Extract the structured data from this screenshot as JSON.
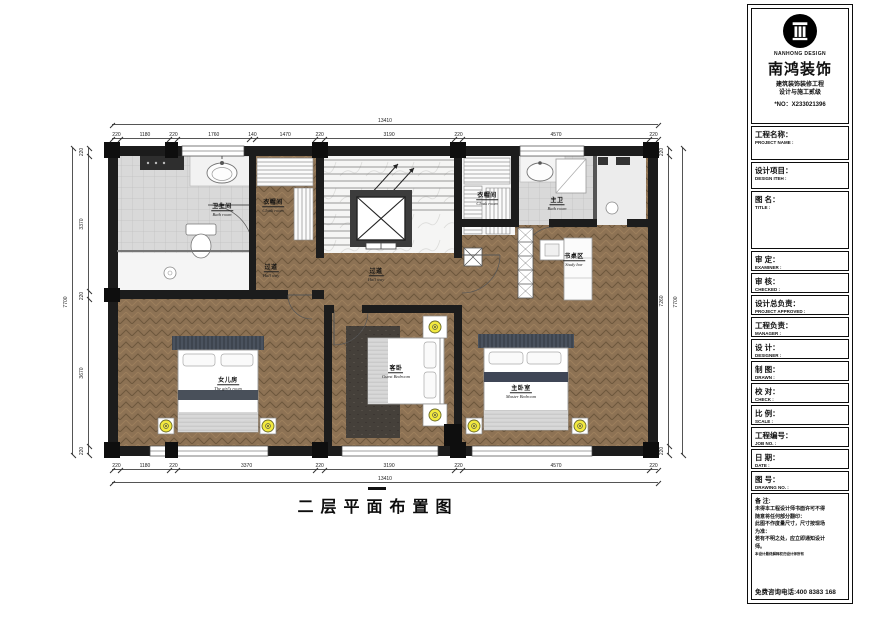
{
  "sheet": {
    "drawing_title": "二层平面布置图",
    "company": {
      "logo": "roman-column-logo",
      "name_en": "NANHONG DESIGN",
      "name_cn": "南鸿装饰",
      "cert_line1": "建筑装饰装修工程",
      "cert_line2": "设计与施工贰级",
      "license_no": "*NO：X233021396"
    },
    "fields": [
      {
        "cn": "工程名称：",
        "en": "PROJECT NAME :"
      },
      {
        "cn": "设计项目：",
        "en": "DESIGN ITEH :"
      },
      {
        "cn": "图  名：",
        "en": "TITLE :"
      },
      {
        "cn": "审  定：",
        "en": "EXAMINER :"
      },
      {
        "cn": "审  核：",
        "en": "CHECKED :"
      },
      {
        "cn": "设计总负责：",
        "en": "PROJECT APPROVED :"
      },
      {
        "cn": "工程负责：",
        "en": "MANAGER :"
      },
      {
        "cn": "设  计：",
        "en": "DESIGNER :"
      },
      {
        "cn": "制  图：",
        "en": "DRAWN :"
      },
      {
        "cn": "校  对：",
        "en": "CHECK :"
      },
      {
        "cn": "比  例：",
        "en": "SCALE :"
      },
      {
        "cn": "工程编号：",
        "en": "JOB  NO. :"
      },
      {
        "cn": "日  期：",
        "en": "DATE :"
      },
      {
        "cn": "图  号：",
        "en": "DRAWING NO. :"
      }
    ],
    "notes": {
      "label": "备 注:",
      "lines": [
        "未得本工程设计师书面许可不得",
        "随意将任何部分翻印：",
        "此图不作度量尺寸，尺寸按现场",
        "为准：",
        "若有不明之处，应立即通知设计",
        "师。"
      ],
      "fine_print": "本设计最终解释权归设计师所有",
      "hotline": "免费咨询电话:400 8383 168"
    }
  },
  "dimensions": {
    "top": {
      "overall": "13410",
      "segments": [
        "220",
        "1180",
        "220",
        "1760",
        "140",
        "1470",
        "220",
        "3190",
        "220",
        "4570",
        "220"
      ]
    },
    "bottom": {
      "overall": "13410",
      "segments": [
        "220",
        "1180",
        "220",
        "3370",
        "220",
        "3190",
        "220",
        "4570",
        "220"
      ]
    },
    "left": {
      "overall": "7700",
      "segments": [
        "220",
        "3370",
        "220",
        "3670",
        "220"
      ]
    },
    "right": {
      "overall": "7700",
      "segments": [
        "220",
        "7260",
        "220"
      ]
    }
  },
  "rooms": [
    {
      "cn": "卫生间",
      "en": "Bath room",
      "x": 222,
      "y": 207
    },
    {
      "cn": "衣帽间",
      "en": "Cloak room",
      "x": 273,
      "y": 203
    },
    {
      "cn": "过道",
      "en": "Hall way",
      "x": 271,
      "y": 268
    },
    {
      "cn": "女儿房",
      "en": "The girl's room",
      "x": 228,
      "y": 381
    },
    {
      "cn": "过道",
      "en": "Hall way",
      "x": 376,
      "y": 272
    },
    {
      "cn": "客卧",
      "en": "Guest Bedroom",
      "x": 396,
      "y": 369
    },
    {
      "cn": "主卧室",
      "en": "Master Bedroom",
      "x": 521,
      "y": 389
    },
    {
      "cn": "书桌区",
      "en": "Study bar",
      "x": 574,
      "y": 257
    },
    {
      "cn": "主卫",
      "en": "Bath room",
      "x": 557,
      "y": 201
    },
    {
      "cn": "衣帽间",
      "en": "Cloak room",
      "x": 487,
      "y": 196
    }
  ],
  "colors": {
    "wood": "#8d7254",
    "tile": "#d9d9d9",
    "wall": "#1c1c1c",
    "lamp_yellow": "#f2e93e",
    "throw_navy": "#3f4656"
  }
}
